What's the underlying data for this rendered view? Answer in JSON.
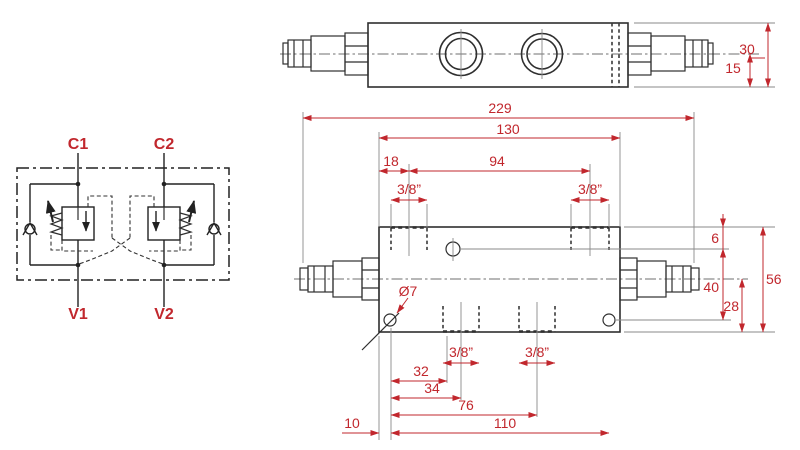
{
  "colors": {
    "dimension_red": "#c1272d",
    "line_dark": "#2f2f2f",
    "line_thin": "#8a8a8a",
    "background": "#ffffff"
  },
  "schematic": {
    "port_top_left": "C1",
    "port_top_right": "C2",
    "port_bottom_left": "V1",
    "port_bottom_right": "V2"
  },
  "top_view": {
    "dim_body_height": "30",
    "dim_center_to_bottom": "15"
  },
  "front_view": {
    "dim_overall_length": "229",
    "dim_body_length": "130",
    "dim_port1_offset": "18",
    "dim_port_spacing": "94",
    "thread_top_left": "3/8”",
    "thread_top_right": "3/8”",
    "dim_hole_from_top": "6",
    "dim_hole_diameter": "Ø7",
    "dim_hole_vertical_span": "40",
    "dim_center_to_bottom": "28",
    "dim_body_height": "56",
    "thread_bottom_left": "3/8”",
    "thread_bottom_right": "3/8”",
    "dim_32": "32",
    "dim_34": "34",
    "dim_76": "76",
    "dim_110": "110",
    "dim_edge_to_hole": "10"
  }
}
